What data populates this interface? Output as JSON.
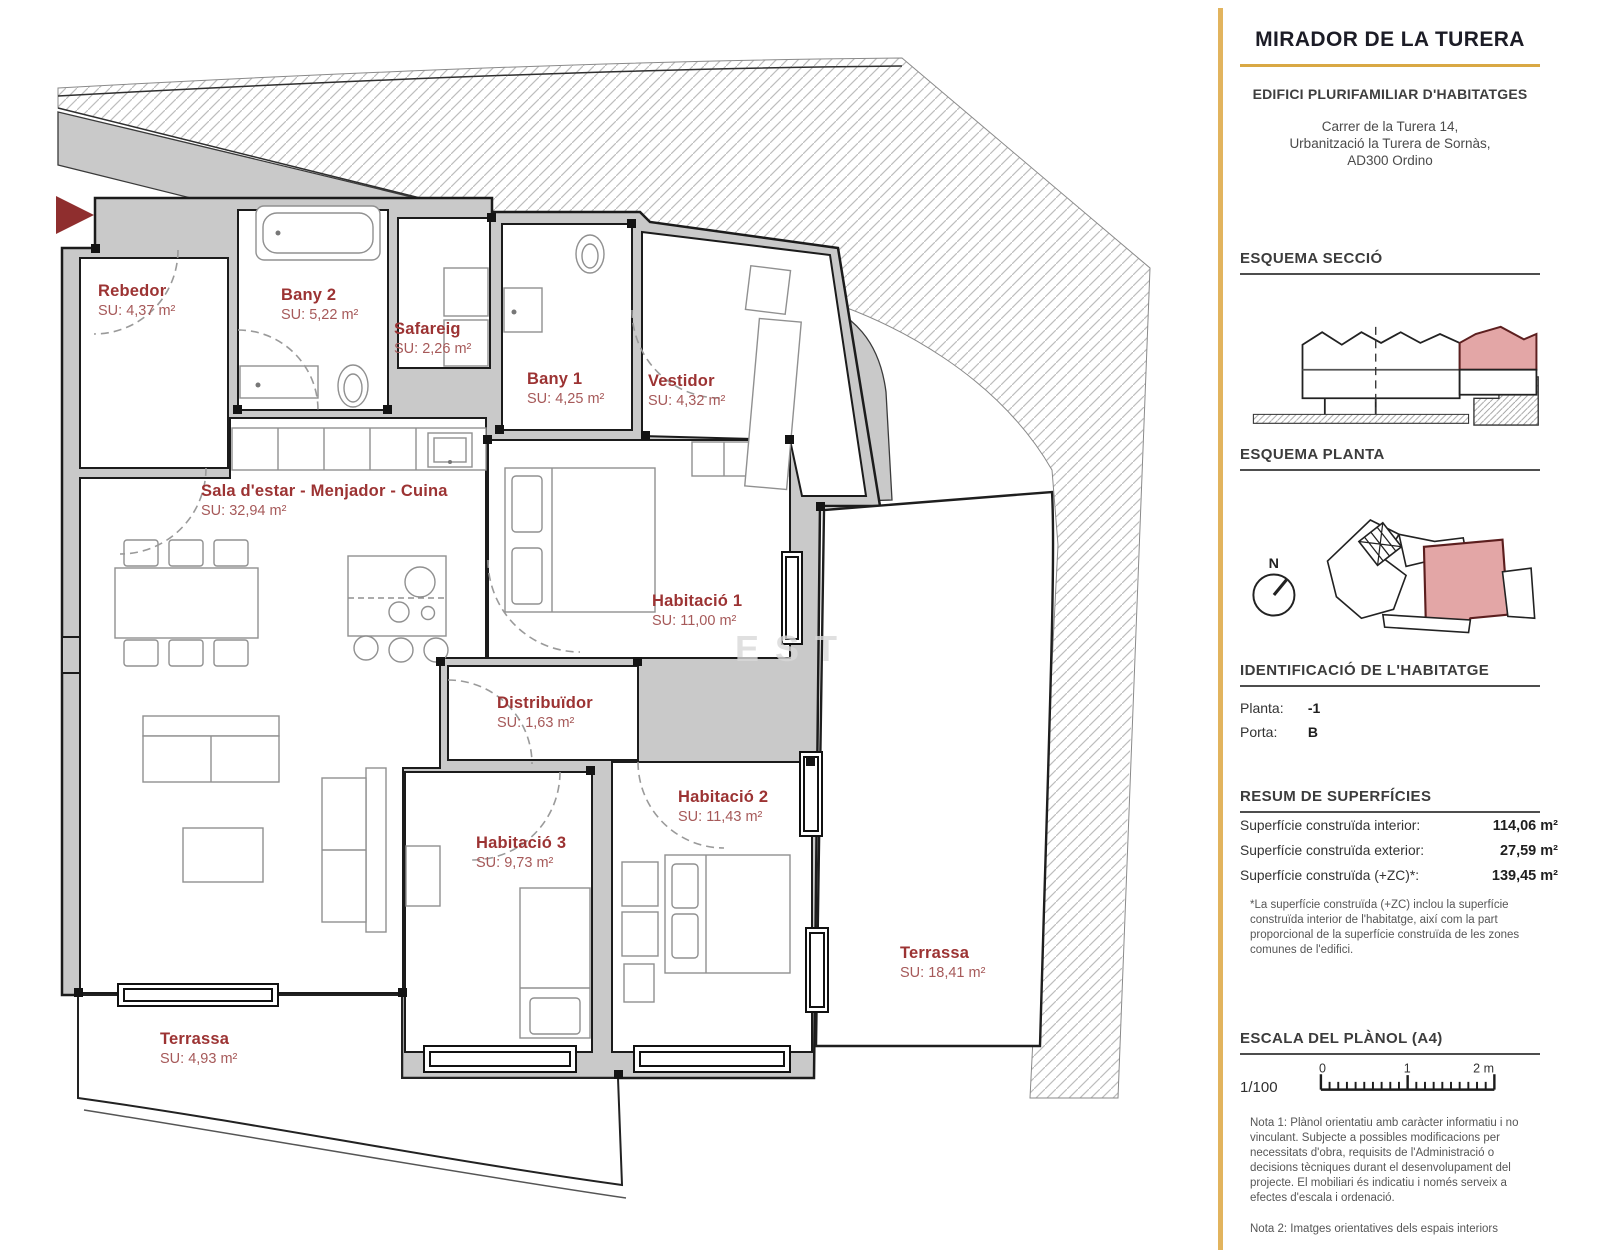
{
  "sidebar": {
    "title": "MIRADOR DE LA TURERA",
    "subtitle": "EDIFICI PLURIFAMILIAR D'HABITATGES",
    "address": {
      "line1": "Carrer de la Turera 14,",
      "line2": "Urbanització la Turera de Sornàs,",
      "line3": "AD300 Ordino"
    },
    "headings": {
      "seccio": "ESQUEMA SECCIÓ",
      "planta": "ESQUEMA PLANTA",
      "identificacio": "IDENTIFICACIÓ DE L'HABITATGE",
      "resum": "RESUM DE SUPERFÍCIES",
      "escala": "ESCALA DEL PLÀNOL (A4)"
    },
    "compass_label": "N",
    "identification": {
      "planta_label": "Planta:",
      "planta_value": "-1",
      "porta_label": "Porta:",
      "porta_value": "B"
    },
    "surfaces": [
      {
        "label": "Superfície construïda interior:",
        "value": "114,06 m²"
      },
      {
        "label": "Superfície construïda exterior:",
        "value": "27,59 m²"
      },
      {
        "label": "Superfície construïda (+ZC)*:",
        "value": "139,45 m²"
      }
    ],
    "surface_note": "*La superfície construïda (+ZC) inclou la superfície construïda interior de l'habitatge, així com la part proporcional de la superfície construïda de les zones comunes de l'edifici.",
    "scale": {
      "ratio": "1/100",
      "tick_0": "0",
      "tick_1": "1",
      "tick_2": "2 m"
    },
    "nota1": "Nota 1: Plànol orientatiu amb caràcter informatiu i no vinculant. Subjecte a possibles modificacions per necessitats d'obra, requisits de l'Administració o decisions tècniques durant el desenvolupament del projecte. El mobiliari és indicatiu i només serveix a efectes d'escala i ordenació.",
    "nota2": "Nota 2: Imatges orientatives dels espais interiors"
  },
  "plan": {
    "watermark": "EST",
    "rooms": [
      {
        "name": "Rebedor",
        "area": "SU: 4,37 m²"
      },
      {
        "name": "Bany 2",
        "area": "SU: 5,22 m²"
      },
      {
        "name": "Safareig",
        "area": "SU: 2,26 m²"
      },
      {
        "name": "Bany 1",
        "area": "SU: 4,25 m²"
      },
      {
        "name": "Vestidor",
        "area": "SU: 4,32 m²"
      },
      {
        "name": "Sala d'estar - Menjador - Cuina",
        "area": "SU: 32,94 m²"
      },
      {
        "name": "Habitació 1",
        "area": "SU: 11,00 m²"
      },
      {
        "name": "Distribuïdor",
        "area": "SU: 1,63 m²"
      },
      {
        "name": "Habitació 2",
        "area": "SU: 11,43 m²"
      },
      {
        "name": "Habitació 3",
        "area": "SU: 9,73 m²"
      },
      {
        "name": "Terrassa",
        "area": "SU: 18,41 m²"
      },
      {
        "name": "Terrassa",
        "area": "SU: 4,93 m²"
      }
    ]
  },
  "colors": {
    "accent_gold": "#e2b45e",
    "rule_gold": "#d9a844",
    "label_red": "#9c3333",
    "highlight_pink": "#e3a6a6",
    "wall_gray": "#c9c9c9"
  }
}
